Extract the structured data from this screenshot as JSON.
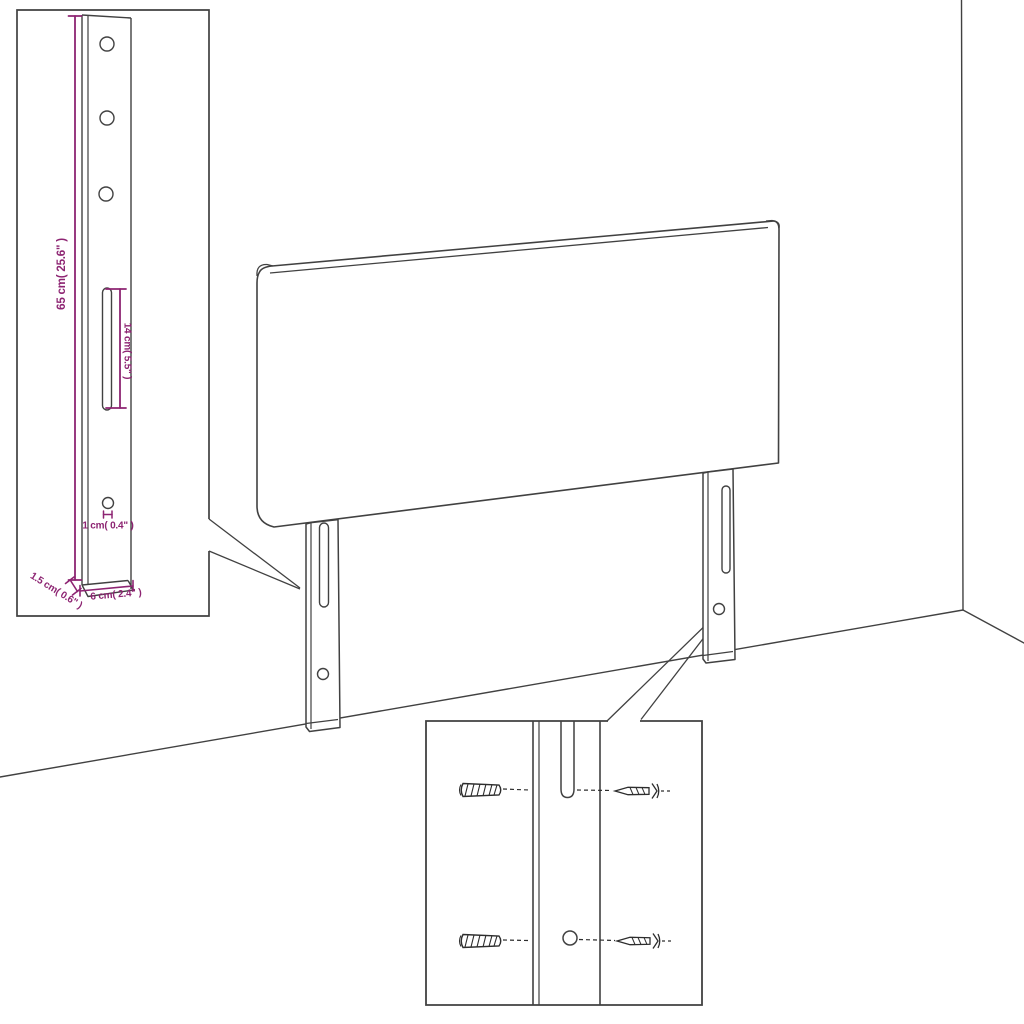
{
  "diagram": {
    "background_color": "#ffffff",
    "line_color": "#414141",
    "dimension_color": "#8d2472"
  },
  "dimension_labels": {
    "leg_height": "65 cm( 25.6\" )",
    "slot_length": "14 cm( 5.5\" )",
    "hole_diameter": "1 cm( 0.4\" )",
    "leg_thickness": "1.5 cm( 0.6\" )",
    "leg_width": "6 cm( 2.4\" )"
  },
  "icons": [
    "wall-plug-icon",
    "screw-icon",
    "mounting-slot",
    "screw-hole",
    "bracket-hole"
  ]
}
